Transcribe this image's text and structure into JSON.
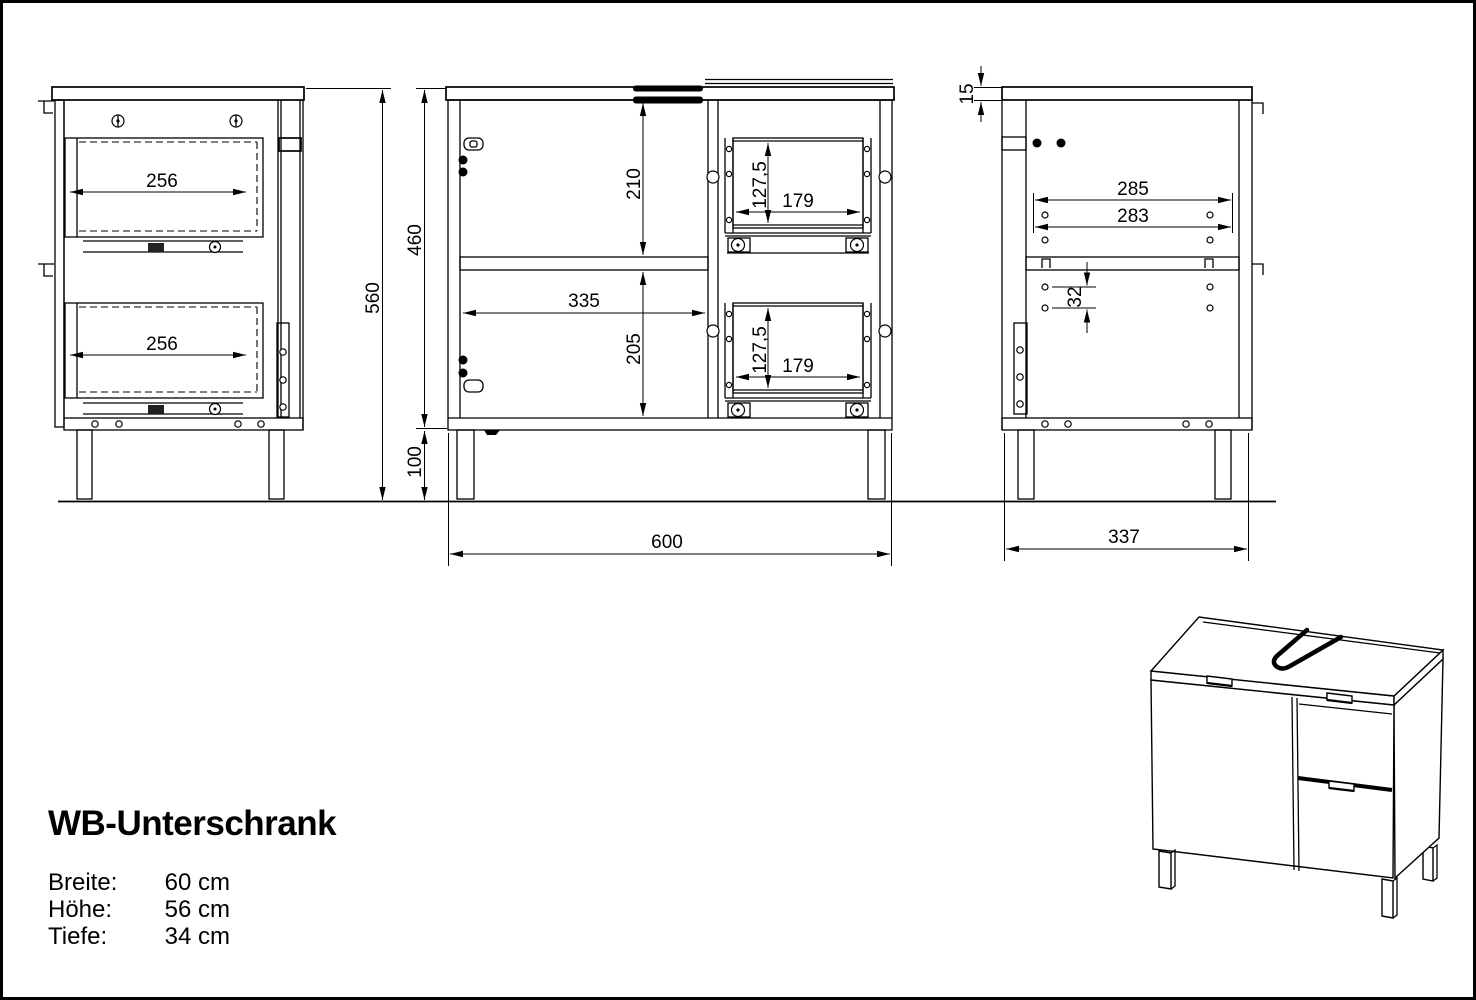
{
  "title": "WB-Unterschrank",
  "specs": {
    "rows": [
      {
        "label": "Breite:",
        "value": "60 cm"
      },
      {
        "label": "Höhe:",
        "value": "56 cm"
      },
      {
        "label": "Tiefe:",
        "value": "34 cm"
      }
    ]
  },
  "dims": {
    "side_drawer_top_depth": "256",
    "side_drawer_bottom_depth": "256",
    "total_height": "560",
    "body_height": "460",
    "leg_height": "100",
    "upper_opening_height": "210",
    "shelf_width": "335",
    "lower_opening_height": "205",
    "drawer_upper_height": "127,5",
    "drawer_upper_width": "179",
    "drawer_lower_height": "127,5",
    "drawer_lower_width": "179",
    "total_width": "600",
    "top_thickness": "15",
    "back_panel_width_outer": "285",
    "back_panel_width_inner": "283",
    "hole_spacing": "32",
    "total_depth": "337"
  }
}
